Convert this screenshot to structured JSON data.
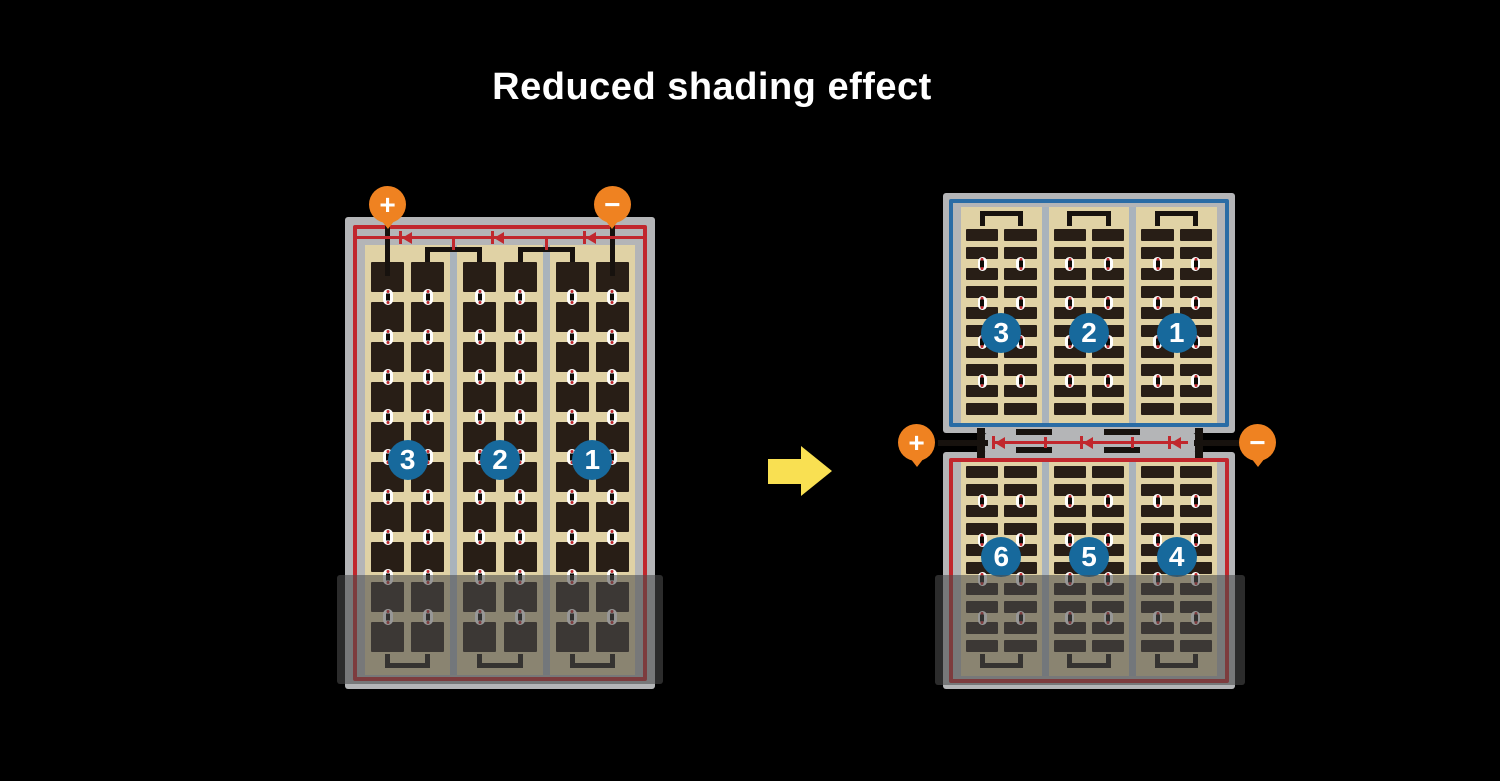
{
  "title": "Reduced shading effect",
  "icons": {
    "arrow": "right-arrow",
    "diode": "left-pointing-diode",
    "positive_terminal": "plus-circle",
    "negative_terminal": "minus-circle"
  },
  "colors": {
    "background": "#000000",
    "frame_gray": "#b4b5b7",
    "divider_gray": "#a9b3bc",
    "panel_tan": "#e0d2a5",
    "cell_dark": "#281e16",
    "accent_red": "#c1272d",
    "accent_blue": "#2a6ca5",
    "badge_blue": "#17699c",
    "terminal_orange": "#ef8221",
    "arrow_yellow": "#f9e052",
    "shade_overlay": "rgba(75,75,75,0.58)"
  },
  "left_panel": {
    "name": "standard full-cell module",
    "positive_label": "+",
    "negative_label": "−",
    "section_labels": [
      "3",
      "2",
      "1"
    ],
    "structure": {
      "groups": 3,
      "columns_per_group": 2,
      "rows": 10,
      "diodes": 3,
      "shaded_rows": 2
    }
  },
  "right_panel": {
    "name": "half-cut twin module",
    "positive_label": "+",
    "negative_label": "−",
    "top_half": {
      "section_labels": [
        "3",
        "2",
        "1"
      ],
      "structure": {
        "groups": 3,
        "columns_per_group": 2,
        "stripe_rows": 10
      }
    },
    "bottom_half": {
      "section_labels": [
        "6",
        "5",
        "4"
      ],
      "structure": {
        "groups": 3,
        "columns_per_group": 2,
        "stripe_rows": 10
      }
    },
    "diodes": 3
  }
}
